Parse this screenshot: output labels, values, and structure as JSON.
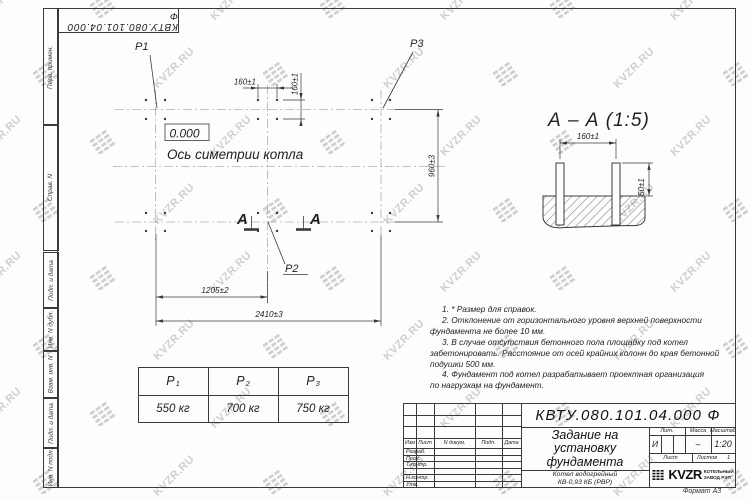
{
  "frame": {
    "ref_number": "КВТУ.080.101.04.000  Ф",
    "top_labels": [
      "Перв. примен.",
      "Справ. N"
    ],
    "bottom_labels": [
      "Подп. и дата",
      "Инв. N дубл.",
      "Взам. инв. N",
      "Подп. и дата",
      "Инв. N подл."
    ],
    "format_label": "Формат А3"
  },
  "watermark": {
    "text": "KVZR.RU"
  },
  "plan": {
    "p1": "P1",
    "p2": "P2",
    "p3": "P3",
    "elevation": "0.000",
    "axis_label": "Ось симетрии котла",
    "dim_160_h": "160±1",
    "dim_160_v": "160±1",
    "dim_960": "960±3",
    "dim_1205": "1205±2",
    "dim_2410": "2410±3",
    "section_letter_left": "А",
    "section_letter_right": "А"
  },
  "section_view": {
    "title": "А – А (1:5)",
    "dim_160": "160±1",
    "dim_50": "50±1"
  },
  "notes": [
    {
      "indent": true,
      "text": "1. * Размер для справок."
    },
    {
      "indent": true,
      "text": "2. Отклонение от горизонтального уровня верхней поверхности"
    },
    {
      "indent": false,
      "text": "фундамента не более 10 мм."
    },
    {
      "indent": true,
      "text": "3. В случае отсутствия бетонного пола площадку под котел"
    },
    {
      "indent": false,
      "text": "забетонировать. Расстояние от осей крайних колонн до края бетонной"
    },
    {
      "indent": false,
      "text": "подушки 500 мм."
    },
    {
      "indent": true,
      "text": "4. Фундамент под котел разрабатывает проектная организация"
    },
    {
      "indent": false,
      "text": "по нагрузкам на фундамент."
    }
  ],
  "load_table": {
    "columns": [
      {
        "name": "P",
        "sub": "1",
        "value": "550 кг"
      },
      {
        "name": "P",
        "sub": "2",
        "value": "700 кг"
      },
      {
        "name": "P",
        "sub": "3",
        "value": "750 кг"
      }
    ]
  },
  "title_block": {
    "doc_number": "КВТУ.080.101.04.000  Ф",
    "title_lines": [
      "Задание на",
      "установку",
      "фундамента"
    ],
    "product_lines": [
      "Котел водогрейный",
      "КВ-0,93 КБ (РВР)"
    ],
    "rev_headers": [
      "Изм",
      "Лист",
      "N докум.",
      "Подп.",
      "Дата"
    ],
    "rev_rows": [
      "Разраб.",
      "Пров.",
      "Т.контр.",
      "",
      "Н.контр.",
      "Утв."
    ],
    "lit_header": "Лит.",
    "lit_value": "И",
    "mass_header": "Масса",
    "mass_value": "–",
    "scale_header": "Масштаб",
    "scale_value": "1:20",
    "sheet_label": "Лист",
    "sheets_label": "Листов",
    "sheets_value": "1",
    "company_name": "KVZR",
    "company_sub1": "КОТЕЛЬНЫЙ",
    "company_sub2": "ЗАВОД РЭП"
  },
  "colors": {
    "line": "#3a3a3a",
    "watermark": "#cfcfcf",
    "paper": "#fdfdfd"
  }
}
